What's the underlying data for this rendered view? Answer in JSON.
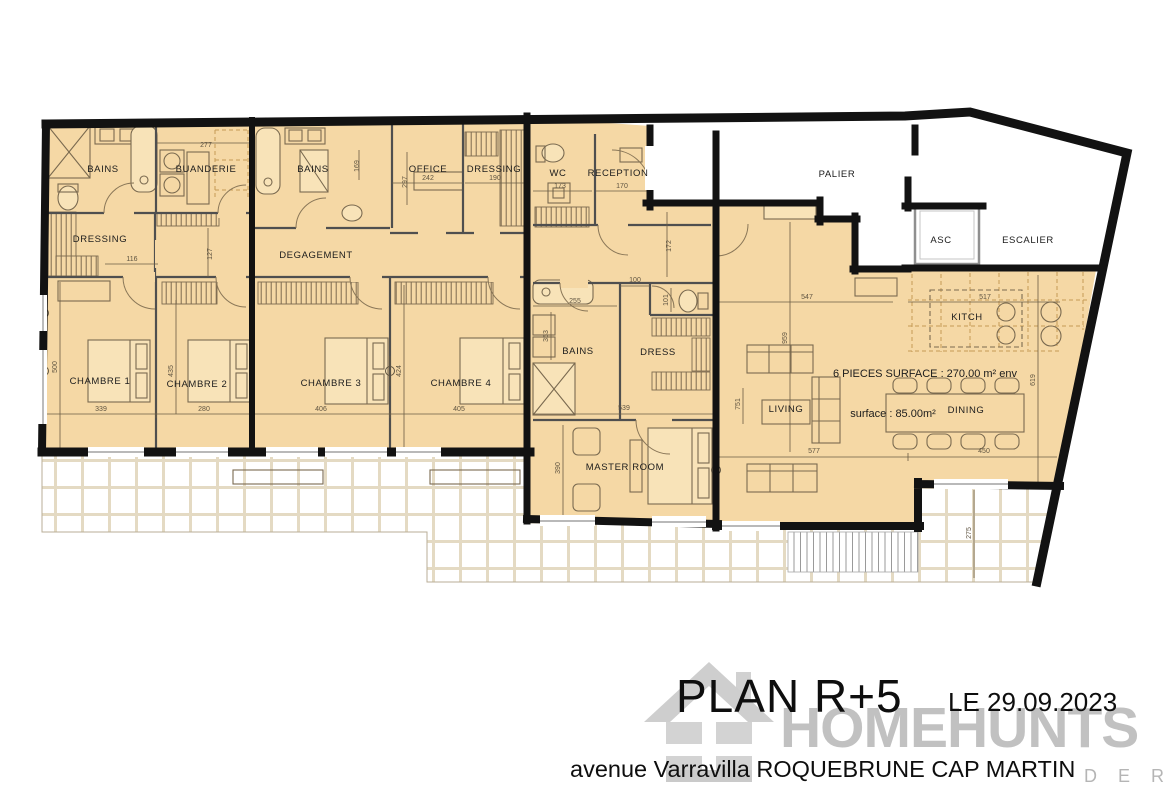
{
  "title_block": {
    "plan_title": "PLAN R+5",
    "date": "LE 29.09.2023",
    "address": "avenue Varravilla ROQUEBRUNE CAP MARTIN"
  },
  "watermark": {
    "brand": "HOMEHUNTS",
    "visible_tagline": "D E R S",
    "logo": "house-icon"
  },
  "colors": {
    "wall": "#121212",
    "room_fill": "#f5d8a5",
    "terrace_grout": "#e4dac3",
    "watermark_gray": "#b4b4b4"
  },
  "rooms": [
    {
      "name": "room-label-bains-1",
      "text": "BAINS",
      "x": 103,
      "y": 172
    },
    {
      "name": "room-label-buanderie",
      "text": "BUANDERIE",
      "x": 206,
      "y": 172
    },
    {
      "name": "room-label-bains-2",
      "text": "BAINS",
      "x": 313,
      "y": 172
    },
    {
      "name": "room-label-office",
      "text": "OFFICE",
      "x": 428,
      "y": 172
    },
    {
      "name": "room-label-dressing-top",
      "text": "DRESSING",
      "x": 494,
      "y": 172,
      "fs": 8.5
    },
    {
      "name": "room-label-wc",
      "text": "WC",
      "x": 558,
      "y": 176
    },
    {
      "name": "room-label-reception",
      "text": "RECEPTION",
      "x": 618,
      "y": 176,
      "fs": 8.5
    },
    {
      "name": "room-label-palier",
      "text": "PALIER",
      "x": 837,
      "y": 177
    },
    {
      "name": "room-label-asc",
      "text": "ASC",
      "x": 941,
      "y": 243
    },
    {
      "name": "room-label-escalier",
      "text": "ESCALIER",
      "x": 1028,
      "y": 243
    },
    {
      "name": "room-label-dressing-left",
      "text": "DRESSING",
      "x": 100,
      "y": 242
    },
    {
      "name": "room-label-degagement",
      "text": "DEGAGEMENT",
      "x": 316,
      "y": 258
    },
    {
      "name": "room-label-chambre-1",
      "text": "CHAMBRE 1",
      "x": 100,
      "y": 384
    },
    {
      "name": "room-label-chambre-2",
      "text": "CHAMBRE 2",
      "x": 197,
      "y": 387
    },
    {
      "name": "room-label-chambre-3",
      "text": "CHAMBRE 3",
      "x": 331,
      "y": 386
    },
    {
      "name": "room-label-chambre-4",
      "text": "CHAMBRE 4",
      "x": 461,
      "y": 386
    },
    {
      "name": "room-label-bains-3",
      "text": "BAINS",
      "x": 578,
      "y": 354
    },
    {
      "name": "room-label-dress",
      "text": "DRESS",
      "x": 658,
      "y": 355
    },
    {
      "name": "room-label-master-room",
      "text": "MASTER ROOM",
      "x": 625,
      "y": 470
    },
    {
      "name": "room-label-living",
      "text": "LIVING",
      "x": 786,
      "y": 412,
      "fs": 8
    },
    {
      "name": "room-label-kitch",
      "text": "KITCH",
      "x": 967,
      "y": 320
    },
    {
      "name": "room-label-dining",
      "text": "DINING",
      "x": 966,
      "y": 413,
      "fs": 8
    }
  ],
  "annotations": [
    {
      "name": "surface-total",
      "text": "6 PIECES SURFACE : 270.00 m² env",
      "x": 925,
      "y": 377
    },
    {
      "name": "surface-note",
      "text": "surface : 85.00m²",
      "x": 893,
      "y": 417
    }
  ],
  "dimensions": [
    {
      "text": "277",
      "x": 206,
      "y": 147
    },
    {
      "text": "242",
      "x": 428,
      "y": 180
    },
    {
      "text": "190",
      "x": 495,
      "y": 180
    },
    {
      "text": "297",
      "x": 407,
      "y": 182,
      "r": 1
    },
    {
      "text": "169",
      "x": 359,
      "y": 166,
      "r": 1
    },
    {
      "text": "173",
      "x": 560,
      "y": 188
    },
    {
      "text": "170",
      "x": 622,
      "y": 188
    },
    {
      "text": "172",
      "x": 671,
      "y": 246,
      "r": 1
    },
    {
      "text": "116",
      "x": 132,
      "y": 261
    },
    {
      "text": "127",
      "x": 212,
      "y": 254,
      "r": 1
    },
    {
      "text": "339",
      "x": 101,
      "y": 411
    },
    {
      "text": "280",
      "x": 204,
      "y": 411
    },
    {
      "text": "406",
      "x": 321,
      "y": 411
    },
    {
      "text": "405",
      "x": 459,
      "y": 411
    },
    {
      "text": "500",
      "x": 57,
      "y": 367,
      "r": 1
    },
    {
      "text": "435",
      "x": 173,
      "y": 371,
      "r": 1
    },
    {
      "text": "424",
      "x": 401,
      "y": 371,
      "r": 1
    },
    {
      "text": "539",
      "x": 624,
      "y": 410
    },
    {
      "text": "255",
      "x": 575,
      "y": 303
    },
    {
      "text": "353",
      "x": 548,
      "y": 336,
      "r": 1
    },
    {
      "text": "100",
      "x": 635,
      "y": 282
    },
    {
      "text": "101",
      "x": 668,
      "y": 300,
      "r": 1
    },
    {
      "text": "390",
      "x": 560,
      "y": 468,
      "r": 1
    },
    {
      "text": "547",
      "x": 807,
      "y": 299
    },
    {
      "text": "517",
      "x": 985,
      "y": 299
    },
    {
      "text": "959",
      "x": 787,
      "y": 338,
      "r": 1
    },
    {
      "text": "751",
      "x": 740,
      "y": 404,
      "r": 1
    },
    {
      "text": "577",
      "x": 814,
      "y": 453
    },
    {
      "text": "450",
      "x": 984,
      "y": 453
    },
    {
      "text": "619",
      "x": 1035,
      "y": 380,
      "r": 1
    },
    {
      "text": "275",
      "x": 971,
      "y": 533,
      "r": 1
    }
  ]
}
